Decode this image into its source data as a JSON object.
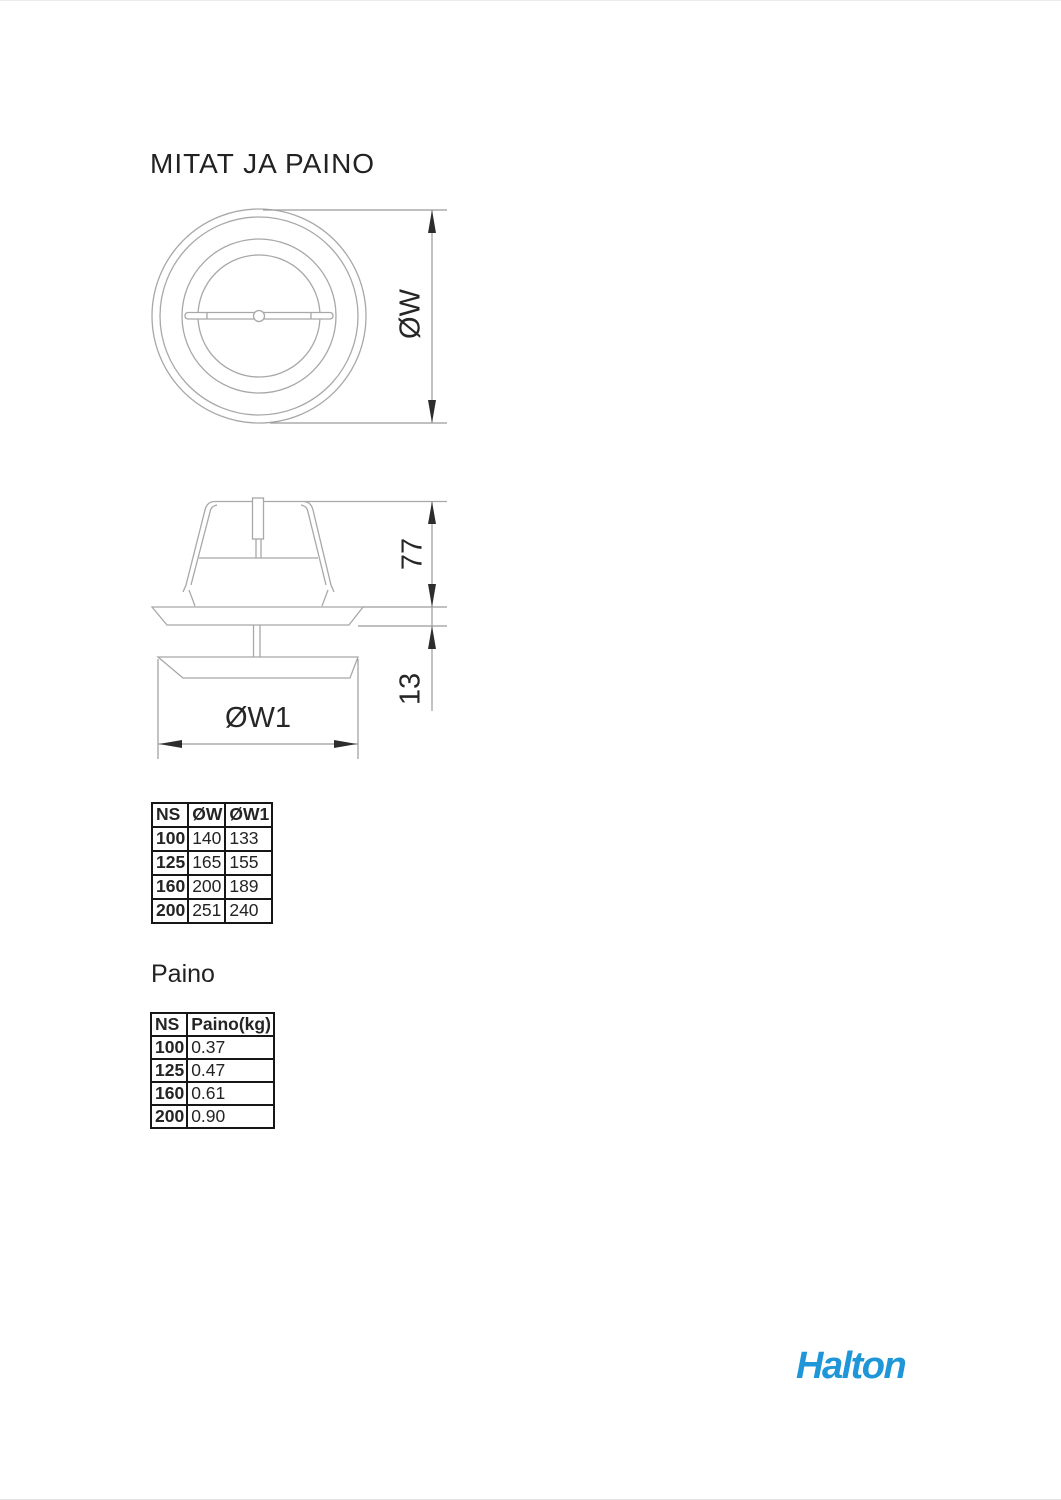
{
  "page": {
    "title": "MITAT JA PAINO",
    "weight_heading": "Paino"
  },
  "drawing": {
    "top_view": {
      "diameter_label": "ØW"
    },
    "side_view": {
      "body_height_label": "77",
      "flange_height_label": "13",
      "face_diameter_label": "ØW1"
    }
  },
  "tables": {
    "dimensions": {
      "columns": [
        "NS",
        "ØW",
        "ØW1"
      ],
      "rows": [
        [
          "100",
          "140",
          "133"
        ],
        [
          "125",
          "165",
          "155"
        ],
        [
          "160",
          "200",
          "189"
        ],
        [
          "200",
          "251",
          "240"
        ]
      ]
    },
    "weight": {
      "columns": [
        "NS",
        "Paino(kg)"
      ],
      "rows": [
        [
          "100",
          "0.37"
        ],
        [
          "125",
          "0.47"
        ],
        [
          "160",
          "0.61"
        ],
        [
          "200",
          "0.90"
        ]
      ]
    }
  },
  "footer": {
    "logo_text": "Halton",
    "logo_color": "#1E96D8"
  }
}
